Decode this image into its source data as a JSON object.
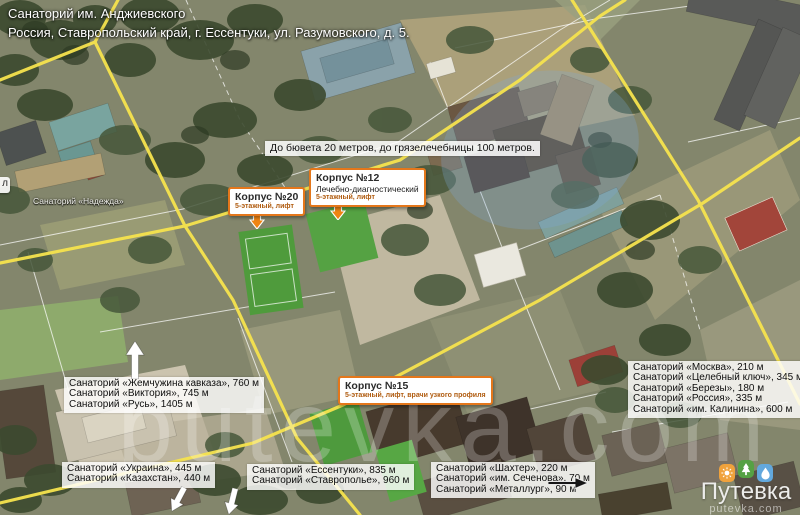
{
  "header": {
    "title": "Санаторий им. Анджиевского",
    "address": "Россия, Ставропольский край, г. Ессентуки, ул. Разумовского, д. 5."
  },
  "note": "До бювета 20 метров, до грязелечебницы 100 метров.",
  "poi_labels": {
    "nadezhda": "Санаторий «Надежда»",
    "edge_chip": "л"
  },
  "callouts": {
    "korpus20": {
      "title": "Корпус №20",
      "line2": "5-этажный, лифт"
    },
    "korpus12": {
      "title": "Корпус №12",
      "line2": "Лечебно-диагностический",
      "line3": "5-этажный, лифт"
    },
    "korpus15": {
      "title": "Корпус №15",
      "line2": "5-этажный, лифт, врачи узкого профиля"
    }
  },
  "distance_boxes": {
    "west": {
      "lines": [
        "Санаторий «Жемчужина кавказа», 760 м",
        "Санаторий «Виктория», 745 м",
        "Санаторий «Русь», 1405 м"
      ]
    },
    "southwest": {
      "lines": [
        "Санаторий «Украина», 445 м",
        "Санаторий «Казахстан», 440 м"
      ]
    },
    "south": {
      "lines": [
        "Санаторий «Ессентуки», 835 м",
        "Санаторий «Ставрополье», 960 м"
      ]
    },
    "southeast": {
      "lines": [
        "Санаторий «Шахтер», 220 м",
        "Санаторий «им. Сеченова», 70 м",
        "Санаторий «Металлург», 90 м"
      ]
    },
    "east": {
      "lines": [
        "Санаторий «Москва», 210 м",
        "Санаторий «Целебный ключ», 345 м",
        "Санаторий «Березы», 180 м",
        "Санаторий «Россия», 335 м",
        "Санаторий «им. Калинина», 600 м"
      ]
    }
  },
  "watermark": "putevka.com",
  "logo": {
    "brand": "Путевка",
    "domain": "putevka.com",
    "pin_colors": {
      "orange": "#f0a23c",
      "green": "#55a143",
      "blue": "#62a8dd"
    }
  },
  "accent_color": "#e4771b",
  "road_color": "#f6e34e"
}
